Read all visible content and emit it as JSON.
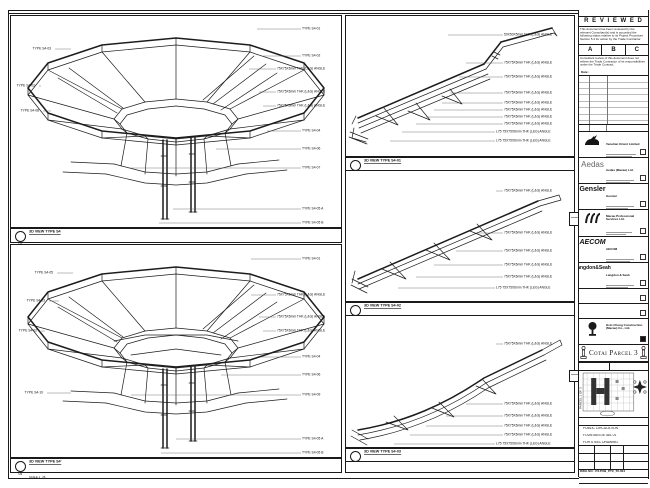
{
  "top_note": "DO NOT SCALE DRAWING. USE FIGURED DIMENSIONS ONLY. VERIFY ALL DIMENSIONS ON SITE.",
  "views": {
    "s4": {
      "bubble": "04",
      "title": "3D VIEW TYPE S4",
      "scale": "SCALE 1 : 25",
      "annos_right": [
        {
          "t": "TYPE S4-01",
          "y": 13,
          "lx": 246,
          "tx": 291
        },
        {
          "t": "TYPE S4-02",
          "y": 40,
          "lx": 252,
          "tx": 291
        },
        {
          "t": "75X75X6mm THK (L&G) ANGLE",
          "y": 53,
          "lx": 238,
          "tx": 266
        },
        {
          "t": "75X75X6mm THK (L&G) ANGLE",
          "y": 76,
          "lx": 248,
          "tx": 266
        },
        {
          "t": "75X75X6mm THK (L&G) ANGLE",
          "y": 90,
          "lx": 252,
          "tx": 266
        },
        {
          "t": "TYPE S4-04",
          "y": 115,
          "lx": 256,
          "tx": 291
        },
        {
          "t": "TYPE S4-06",
          "y": 133,
          "lx": 205,
          "tx": 291
        },
        {
          "t": "TYPE S4-07",
          "y": 152,
          "lx": 118,
          "tx": 291
        },
        {
          "t": "TYPE S4-05 A",
          "y": 193,
          "lx": 162,
          "tx": 291
        },
        {
          "t": "TYPE S4-05 B",
          "y": 207,
          "lx": 148,
          "tx": 291
        }
      ],
      "annos_left": [
        {
          "t": "TYPE S4-03",
          "y": 33,
          "lx": 60,
          "tx": 42,
          "side": "left"
        },
        {
          "t": "TYPE S4-02",
          "y": 70,
          "lx": 30,
          "tx": 26,
          "side": "left"
        },
        {
          "t": "TYPE S4-08",
          "y": 95,
          "lx": 40,
          "tx": 30,
          "side": "left"
        }
      ]
    },
    "s4b": {
      "bubble": "05",
      "title": "3D VIEW TYPE S4'",
      "scale": "SCALE 1 : 25",
      "annos_right": [
        {
          "t": "TYPE S4-01",
          "y": 14,
          "lx": 240,
          "tx": 291
        },
        {
          "t": "75X75X6mm THK (L&G) ANGLE",
          "y": 50,
          "lx": 240,
          "tx": 266
        },
        {
          "t": "75X75X6mm THK (L&G) ANGLE",
          "y": 72,
          "lx": 248,
          "tx": 266
        },
        {
          "t": "75X75X6mm THK (L&G) ANGLE",
          "y": 86,
          "lx": 252,
          "tx": 266
        },
        {
          "t": "TYPE S4-04",
          "y": 112,
          "lx": 250,
          "tx": 291
        },
        {
          "t": "TYPE S4-06",
          "y": 130,
          "lx": 210,
          "tx": 291
        },
        {
          "t": "TYPE S4-09",
          "y": 150,
          "lx": 120,
          "tx": 291
        },
        {
          "t": "TYPE S4-05 A",
          "y": 194,
          "lx": 165,
          "tx": 291
        },
        {
          "t": "TYPE S4-05 B",
          "y": 208,
          "lx": 150,
          "tx": 291
        }
      ],
      "annos_left": [
        {
          "t": "TYPE S4-05",
          "y": 28,
          "lx": 62,
          "tx": 44,
          "side": "left"
        },
        {
          "t": "TYPE S4-03",
          "y": 56,
          "lx": 48,
          "tx": 36,
          "side": "left"
        },
        {
          "t": "TYPE S4-02",
          "y": 86,
          "lx": 34,
          "tx": 28,
          "side": "left"
        },
        {
          "t": "TYPE S4-10",
          "y": 148,
          "lx": 60,
          "tx": 34,
          "side": "left"
        }
      ]
    },
    "d1": {
      "bubble": "01",
      "title": "3D VIEW TYPE S4-01",
      "scale": "SCALE 1 : 10",
      "qty": "QUANTITY : 4",
      "annos": [
        {
          "t": "50X50X5mm THK (L&G) ANGLE",
          "y": 19,
          "lx": 102,
          "tx": 158
        },
        {
          "t": "75X75X6mm THK (L&G) ANGLE",
          "y": 47,
          "lx": 120,
          "tx": 158
        },
        {
          "t": "75X75X6mm THK (L&G) ANGLE",
          "y": 61,
          "lx": 113,
          "tx": 158
        },
        {
          "t": "75X75X6mm THK (L&G) ANGLE",
          "y": 77,
          "lx": 104,
          "tx": 158
        },
        {
          "t": "75X75X6mm THK (L&G) ANGLE",
          "y": 87,
          "lx": 96,
          "tx": 158
        },
        {
          "t": "75X75X6mm THK (L&G) ANGLE",
          "y": 94,
          "lx": 88,
          "tx": 158
        },
        {
          "t": "75X75X6mm THK (L&G) ANGLE",
          "y": 101,
          "lx": 80,
          "tx": 158
        },
        {
          "t": "75X75X6mm THK (L&G) ANGLE",
          "y": 108,
          "lx": 70,
          "tx": 158
        },
        {
          "t": "L75 75X75X6mm THK (L&G) ANGLE",
          "y": 116,
          "lx": 56,
          "tx": 150
        },
        {
          "t": "L75 75X75X6mm THK (L&G) ANGLE",
          "y": 125,
          "lx": 44,
          "tx": 150
        }
      ]
    },
    "d2": {
      "bubble": "02",
      "title": "3D VIEW TYPE S4-02",
      "scale": "SCALE 1 : 10",
      "qty": "QUANTITY : 4",
      "annos": [
        {
          "t": "75X75X6mm THK (L&G) ANGLE",
          "y": 20,
          "lx": 150,
          "tx": 158
        },
        {
          "t": "75X75X6mm THK (L&G) ANGLE",
          "y": 62,
          "lx": 130,
          "tx": 158
        },
        {
          "t": "75X75X6mm THK (L&G) ANGLE",
          "y": 80,
          "lx": 110,
          "tx": 158
        },
        {
          "t": "75X75X6mm THK (L&G) ANGLE",
          "y": 94,
          "lx": 88,
          "tx": 158
        },
        {
          "t": "75X75X6mm THK (L&G) ANGLE",
          "y": 106,
          "lx": 70,
          "tx": 158
        },
        {
          "t": "L75 75X75X6mm THK (L&G) ANGLE",
          "y": 117,
          "lx": 52,
          "tx": 150
        }
      ]
    },
    "d3": {
      "bubble": "03",
      "title": "3D VIEW TYPE S4-03",
      "scale": "SCALE 1 : 10",
      "qty": "QUANTITY : 4",
      "annos": [
        {
          "t": "75X75X6mm THK (L&G) ANGLE",
          "y": 28,
          "lx": 150,
          "tx": 158
        },
        {
          "t": "75X75X6mm THK (L&G) ANGLE",
          "y": 88,
          "lx": 120,
          "tx": 158
        },
        {
          "t": "75X75X6mm THK (L&G) ANGLE",
          "y": 100,
          "lx": 100,
          "tx": 158
        },
        {
          "t": "75X75X6mm THK (L&G) ANGLE",
          "y": 110,
          "lx": 80,
          "tx": 158
        },
        {
          "t": "75X75X6mm THK (L&G) ANGLE",
          "y": 119,
          "lx": 64,
          "tx": 158
        },
        {
          "t": "L75 75X75X6mm THK (L&G) ANGLE",
          "y": 128,
          "lx": 48,
          "tx": 150
        }
      ]
    }
  },
  "stamp": {
    "title": "R E V I E W E D",
    "para1": "This document has been reviewed by the relevant Consultant(s) and is accorded the following status relative to its Project Procedure Section 5.4 for action by the Trade Contractor.",
    "boxes": [
      "A",
      "B",
      "C"
    ],
    "para2": "Consultant review of this document does not relieve the Trade Contractor of its responsibilities under the Trade Contract.",
    "date_label": "Date :"
  },
  "rev_table": {
    "headers": [
      "REV",
      "DATE",
      "DESCRIPTION"
    ]
  },
  "companies": [
    {
      "name": "Venetian Orient Limited"
    },
    {
      "logo": "Aedas",
      "name": "Aedas (Macau) Ltd."
    },
    {
      "logo": "Gensler",
      "name": "Gensler"
    },
    {
      "name": "Macau Professional Services Ltd."
    },
    {
      "logo": "AECOM",
      "name": "AECOM"
    },
    {
      "logo": "Langdon&Seah",
      "name": "Langdon & Seah"
    },
    {
      "name": ""
    },
    {
      "name": ""
    },
    {
      "name": "Hsin Chong Construction (Macau) Co., Ltd."
    }
  ],
  "project": {
    "banner": "Cotai Parcel 3"
  },
  "keyplan": {
    "label": "KEY PLAN",
    "scale": "SCALE 1 : 2000",
    "side_text": "PARCEL 1 OF 3"
  },
  "titleblock": {
    "drawing_title_label": "DRAWING TITLE :",
    "title_lines": [
      "PUBLIC CIRCULATION",
      "FOUNTAIN DETAIL 01",
      "FOR STEEL DRAWING"
    ],
    "fields": [
      {
        "label": "DESIGNED",
        "value": "-"
      },
      {
        "label": "DRAWN",
        "value": "DINO"
      },
      {
        "label": "CHECKED",
        "value": "-"
      },
      {
        "label": "DATE",
        "value": "1-MAR-10"
      },
      {
        "label": "APPROVED",
        "value": "-"
      },
      {
        "label": "SCALE",
        "value": "AS SHOWN"
      }
    ],
    "dwg_label": "DWG NO :",
    "dwg_no": "P3-PUB_PTC_55-004",
    "rev": "REV : A",
    "rows": [
      "JOB NUMBER : 91508",
      "CAD FILE : P3-PUB_PTC_55-004.dwg",
      "REFERENCE : P3_PUB_PTC"
    ]
  }
}
